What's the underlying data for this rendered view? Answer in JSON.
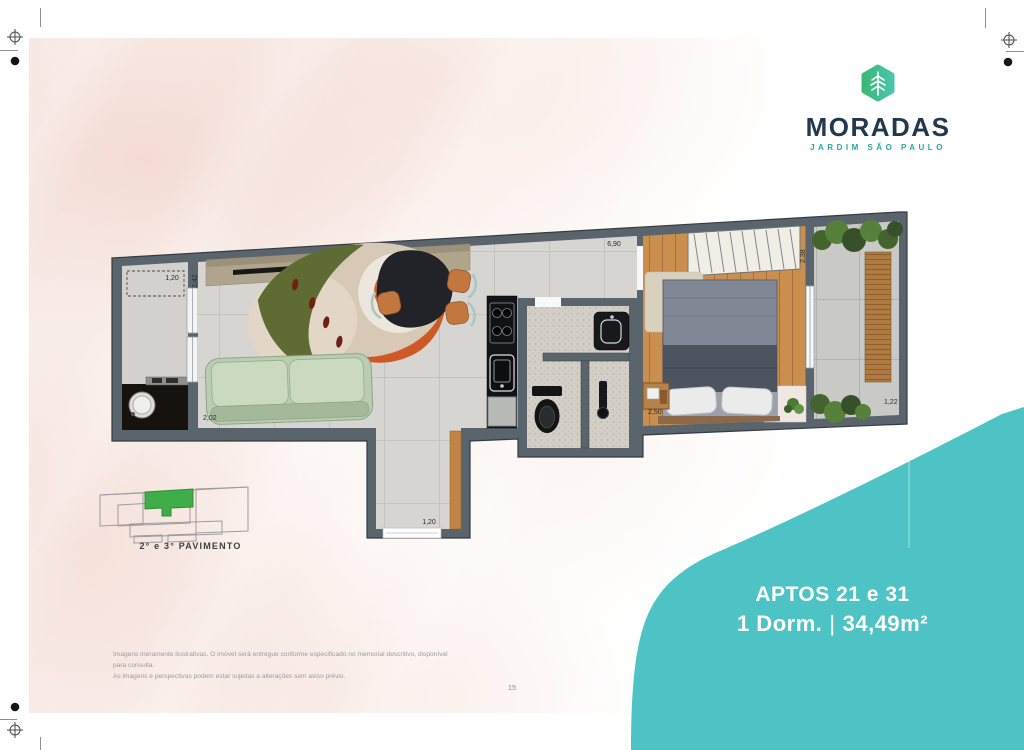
{
  "brand": {
    "name": "MORADAS",
    "subtitle": "JARDIM SÃO PAULO"
  },
  "unit_badge": {
    "title": "APTOS 21 e 31",
    "dorm": "1 Dorm.",
    "separator": "|",
    "area": "34,49m²"
  },
  "keyplan": {
    "caption": "2° e 3° PAVIMENTO"
  },
  "floorplan": {
    "dims": {
      "service_width": "1,20",
      "service_depth": "2,42",
      "living_width": "2,02",
      "top_span": "6,90",
      "wardrobe_span": "2,38",
      "bedroom_width": "2,50",
      "balcony_width": "1,22",
      "entry_width": "1,20"
    }
  },
  "footer": {
    "disclaimer_line1": "Imagens meramente ilustrativas. O imóvel será entregue conforme especificado no memorial descritivo, disponível para consulta.",
    "disclaimer_line2": "As imagens e perspectivas podem estar sujeitas a alterações sem aviso prévio.",
    "page_number": "15"
  },
  "colors": {
    "accent_teal": "#4EC3C5",
    "brand_navy": "#21394E",
    "brand_teal": "#2BA4A6",
    "leaf_green": "#3CB878",
    "keyplan_green": "#3FAE49",
    "wall_gray": "#5A646D"
  }
}
